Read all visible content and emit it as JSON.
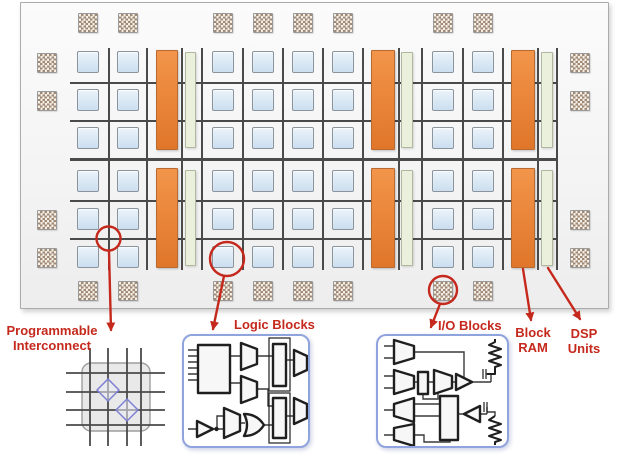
{
  "legend": {
    "interconnect": {
      "line1": "Programmable",
      "line2": "Interconnect"
    },
    "logic": "Logic Blocks",
    "io": "I/O Blocks",
    "bram": {
      "line1": "Block",
      "line2": "RAM"
    },
    "dsp": {
      "line1": "DSP",
      "line2": "Units"
    }
  },
  "colors": {
    "die_border": "#ABABAB",
    "grid_line": "#4A4A4A",
    "logic_fill_top": "#EBF3FA",
    "logic_fill_bottom": "#CBDEEF",
    "logic_border": "#8A949D",
    "bram_fill_top": "#F2954A",
    "bram_fill_bottom": "#E0762A",
    "bram_border": "#B96A30",
    "dsp_fill": "#EAF0DC",
    "dsp_border": "#AFB79F",
    "pad_dark": "#A08A76",
    "pad_light": "#F4EFE7",
    "pad_border": "#9A9A9A",
    "accent_red": "#C5281C",
    "inset_border": "#8FA3DC",
    "xbar_fill": "#E9E9E9",
    "xbar_border": "#9E9E9E",
    "diamond_stroke": "#7D7FD1",
    "circuit_stroke": "#1F1F1F",
    "circuit_fill": "#F7F7F7"
  },
  "fabric": {
    "block_size": 22,
    "pad_size": 20,
    "logic_cols": [
      77,
      117,
      212,
      252,
      292,
      332,
      432,
      472
    ],
    "logic_rows_top": [
      51,
      89,
      127
    ],
    "logic_rows_bottom": [
      170,
      208,
      246
    ],
    "bram_columns": [
      {
        "x": 156,
        "w": 22
      },
      {
        "x": 371,
        "w": 24
      },
      {
        "x": 511,
        "w": 24
      }
    ],
    "bram_spans": [
      {
        "y": 50,
        "h": 100
      },
      {
        "y": 168,
        "h": 100
      }
    ],
    "dsp_columns": [
      {
        "x": 185,
        "w": 11
      },
      {
        "x": 401,
        "w": 12
      },
      {
        "x": 541,
        "w": 12
      }
    ],
    "dsp_spans": [
      {
        "y": 52,
        "h": 96
      },
      {
        "y": 170,
        "h": 96
      }
    ],
    "io_top_y": 13,
    "io_bottom_y": 281,
    "io_side_ys": [
      53,
      91,
      210,
      248
    ],
    "io_left_x": 37,
    "io_right_x": 570,
    "grid_vlines": {
      "xs": [
        108,
        146,
        181,
        201,
        242,
        282,
        322,
        362,
        398,
        421,
        462,
        502,
        537,
        556
      ],
      "y1": 48,
      "y2": 270
    },
    "grid_hlines": {
      "ys": [
        82,
        120,
        200,
        238
      ],
      "x1": 70,
      "x2": 556
    },
    "mid_divider": {
      "y": 158,
      "x1": 70,
      "x2": 556
    }
  },
  "callouts": [
    {
      "name": "programmable-interconnect",
      "circle": {
        "cx": 108.5,
        "cy": 238.5,
        "r": 12
      },
      "arrow": {
        "x1": 109,
        "y1": 251,
        "x2": 111,
        "y2": 330
      }
    },
    {
      "name": "logic-blocks",
      "circle": {
        "cx": 227,
        "cy": 259,
        "r": 17
      },
      "arrow": {
        "x1": 224,
        "y1": 276,
        "x2": 213,
        "y2": 329
      }
    },
    {
      "name": "io-blocks",
      "circle": {
        "cx": 443,
        "cy": 290,
        "r": 14
      },
      "arrow": {
        "x1": 440,
        "y1": 304,
        "x2": 431,
        "y2": 327
      }
    },
    {
      "name": "block-ram",
      "arrow": {
        "x1": 523,
        "y1": 269,
        "x2": 531,
        "y2": 320
      }
    },
    {
      "name": "dsp-units",
      "arrow": {
        "x1": 548,
        "y1": 268,
        "x2": 580,
        "y2": 319
      }
    }
  ]
}
